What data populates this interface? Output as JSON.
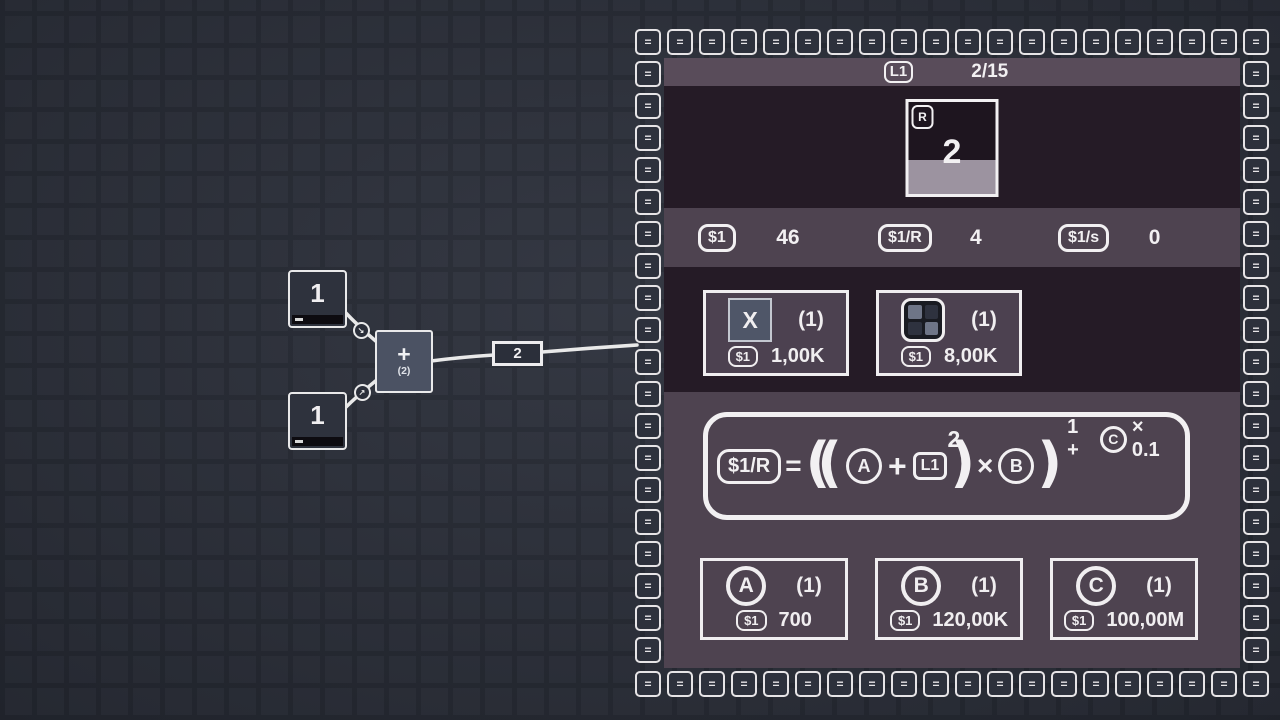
{
  "canvas": {
    "source_nodes": [
      {
        "value": "1",
        "decrement": "-"
      },
      {
        "value": "1",
        "decrement": "-"
      }
    ],
    "operator_node": {
      "symbol": "+",
      "operand_count": "(2)"
    },
    "wire_label": {
      "value": "2"
    },
    "connector_arrows": [
      "↘",
      "↗"
    ]
  },
  "panel": {
    "border_tile_glyph": "=",
    "header": {
      "level_badge": "L1",
      "progress": "2/15"
    },
    "target_card": {
      "corner_badge": "R",
      "value": "2",
      "progress_percent": 37
    },
    "stats": [
      {
        "badge": "$1",
        "value": "46"
      },
      {
        "badge": "$1/R",
        "value": "4"
      },
      {
        "badge": "$1/s",
        "value": "0"
      }
    ],
    "shop_items": [
      {
        "icon": "x-tile",
        "tile_label": "X",
        "count": "(1)",
        "currency_badge": "$1",
        "price": "1,00K"
      },
      {
        "icon": "grid-tile",
        "count": "(1)",
        "currency_badge": "$1",
        "price": "8,00K"
      }
    ],
    "formula": {
      "result_badge": "$1/R",
      "equals": "=",
      "open_parens": "((",
      "var_a": "A",
      "plus": "+",
      "level_box": "L1",
      "level_exponent": "2",
      "close_paren_inner": ")",
      "times": "×",
      "var_b": "B",
      "close_paren_outer": ")",
      "exponent_prefix": "1 +",
      "exponent_var": "C",
      "exponent_suffix": "× 0.1"
    },
    "upgrades": [
      {
        "letter": "A",
        "count": "(1)",
        "currency_badge": "$1",
        "price": "700"
      },
      {
        "letter": "B",
        "count": "(1)",
        "currency_badge": "$1",
        "price": "120,00K"
      },
      {
        "letter": "C",
        "count": "(1)",
        "currency_badge": "$1",
        "price": "100,00M"
      }
    ],
    "colors": {
      "panel_dark": "#251b26",
      "panel_purple": "#4e4350",
      "header_purple": "#594c5a",
      "progress_fill": "#9c93a0",
      "tile_bg": "#2d313c",
      "background": "#2e323d"
    }
  }
}
